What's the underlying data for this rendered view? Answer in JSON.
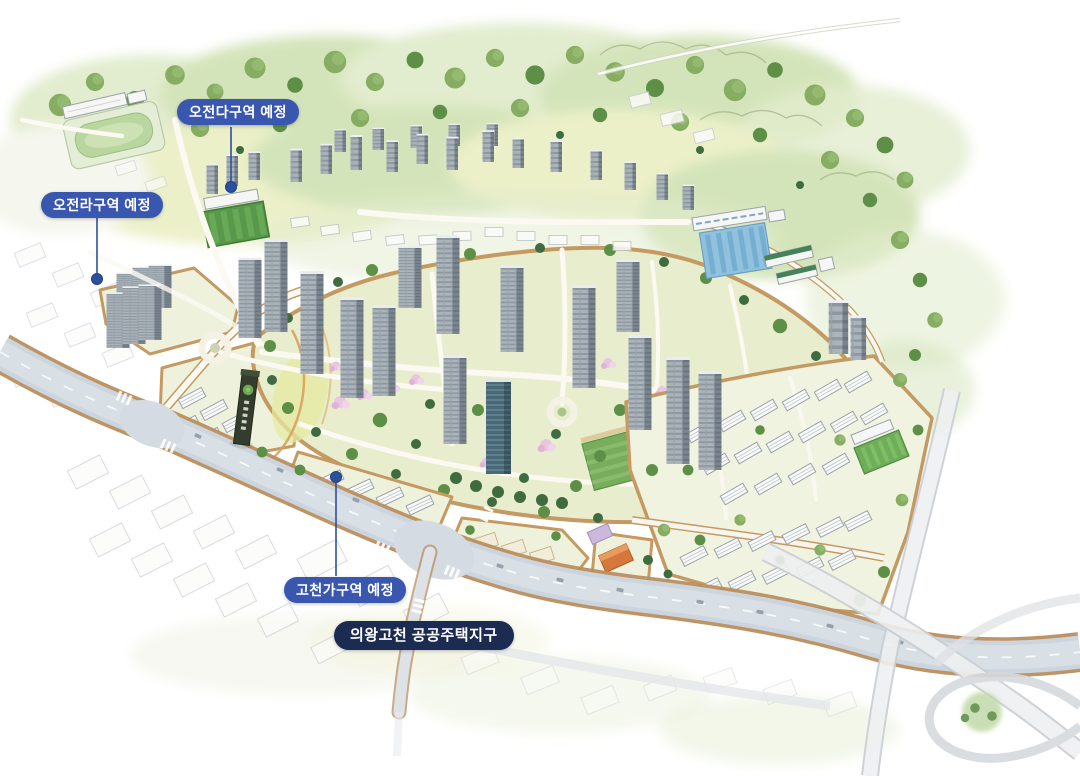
{
  "callouts": [
    {
      "id": "ojeon-da",
      "label": "오전다구역 예정",
      "style": "blue"
    },
    {
      "id": "ojeon-ra",
      "label": "오전라구역 예정",
      "style": "blue"
    },
    {
      "id": "gocheon-ga",
      "label": "고천가구역 예정",
      "style": "blue"
    },
    {
      "id": "uiwang-gocheon",
      "label": "의왕고천 공공주택지구",
      "style": "navy"
    }
  ],
  "colors": {
    "callout_blue": "#3a57b0",
    "callout_navy": "#1c2b52",
    "marker_blue": "#2e4f9f",
    "leader_line": "#2e4f9f"
  }
}
